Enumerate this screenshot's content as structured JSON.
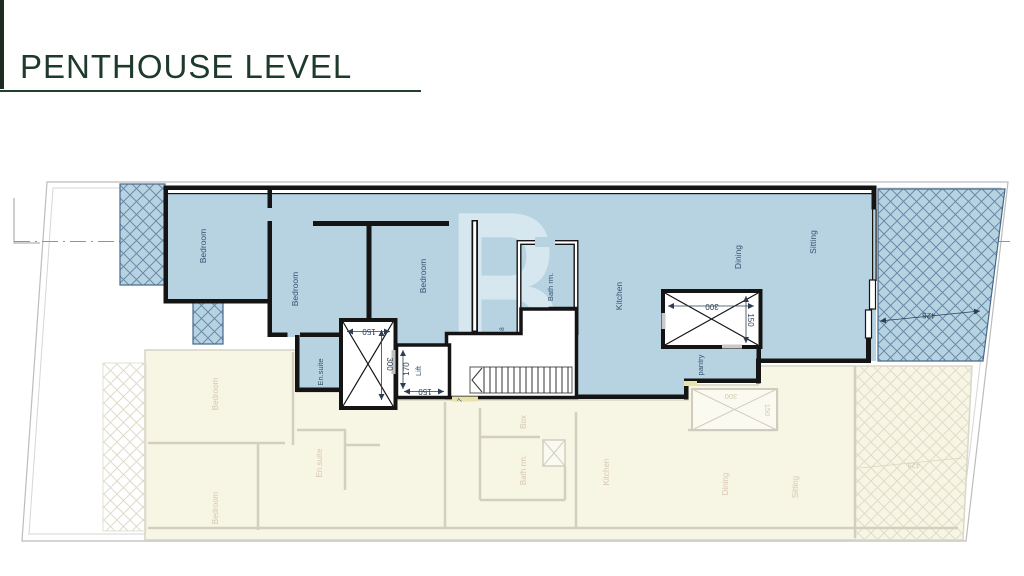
{
  "title": {
    "text": "PENTHOUSE LEVEL"
  },
  "watermark": {
    "letter": "B"
  },
  "colors": {
    "title_green": "#1d3a2b",
    "plan_fill": "#b7d3e2",
    "hatch_line": "#55779a",
    "wall": "#141414",
    "ghost_fill": "#f7f5e3",
    "ghost_line": "#d2cfc0",
    "door_sill": "#e9e3a9"
  },
  "penthouse": {
    "rooms": [
      {
        "name": "bedroom-1",
        "label": "Bedroom"
      },
      {
        "name": "bedroom-2",
        "label": "Bedroom"
      },
      {
        "name": "bedroom-3",
        "label": "Bedroom"
      },
      {
        "name": "ensuite",
        "label": "En.suite"
      },
      {
        "name": "bathroom",
        "label": "Bath rm."
      },
      {
        "name": "kitchen",
        "label": "Kitchen"
      },
      {
        "name": "dining",
        "label": "Dining"
      },
      {
        "name": "sitting",
        "label": "Sitting"
      },
      {
        "name": "pantry",
        "label": "pantry"
      },
      {
        "name": "lift",
        "label": "Lift"
      }
    ],
    "dimensions": [
      {
        "name": "shaft-width",
        "label": "150"
      },
      {
        "name": "shaft-depth",
        "label": "300"
      },
      {
        "name": "lift-depth",
        "label": "170"
      },
      {
        "name": "lift-width",
        "label": "150"
      },
      {
        "name": "void-width",
        "label": "300"
      },
      {
        "name": "void-depth",
        "label": "150"
      },
      {
        "name": "terrace-width",
        "label": "425"
      }
    ],
    "stair_labels": [
      {
        "label": "8"
      },
      {
        "label": "7"
      }
    ]
  },
  "lower_level": {
    "rooms": [
      {
        "name": "bedroom-1",
        "label": "Bedroom"
      },
      {
        "name": "bedroom-2",
        "label": "Bedroom"
      },
      {
        "name": "ensuite",
        "label": "En.suite"
      },
      {
        "name": "box",
        "label": "Box"
      },
      {
        "name": "bathroom",
        "label": "Bath rm."
      },
      {
        "name": "kitchen",
        "label": "Kitchen"
      },
      {
        "name": "pantry",
        "label": "pantry"
      },
      {
        "name": "dining",
        "label": "Dining"
      },
      {
        "name": "sitting",
        "label": "Sitting"
      }
    ],
    "dimensions": [
      {
        "name": "void-width",
        "label": "300"
      },
      {
        "name": "void-depth",
        "label": "150"
      },
      {
        "name": "terrace-width",
        "label": "425"
      }
    ]
  }
}
